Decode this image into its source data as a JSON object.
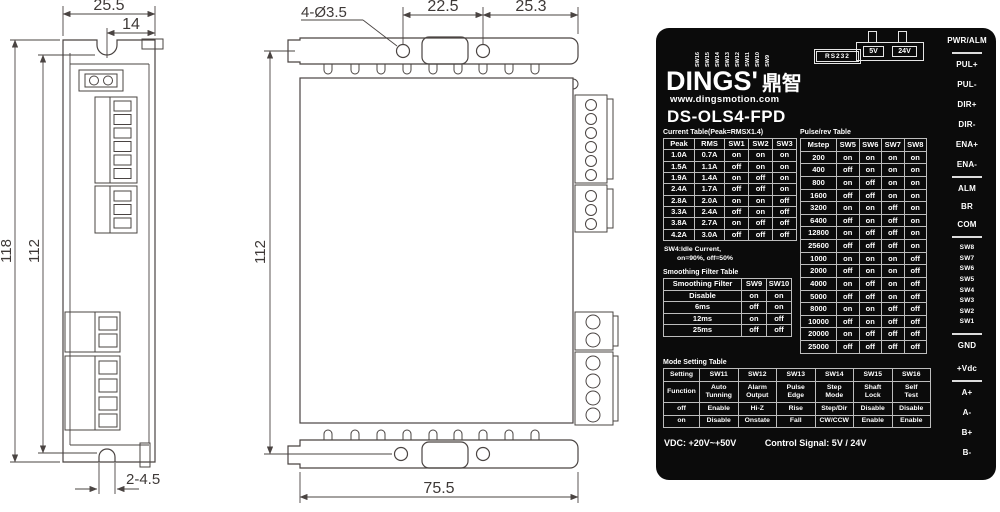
{
  "colors": {
    "panel_bg": "#0b0b0b",
    "panel_text": "#ffffff",
    "drawing_line": "#4a4442"
  },
  "front_view": {
    "dim_width": "25.5",
    "dim_notch": "14",
    "dim_height_outer": "118",
    "dim_height_inner": "112",
    "dim_slot": "2-4.5"
  },
  "side_view": {
    "dim_holes": "4-Ø3.5",
    "dim_hole_spacing": "22.5",
    "dim_edge_offset": "25.3",
    "dim_height": "112",
    "dim_width": "75.5"
  },
  "panel": {
    "brand": "DINGS'",
    "brand_cn": "鼎智",
    "website": "www.dingsmotion.com",
    "model": "DS-OLS4-FPD",
    "dip_labels": [
      "SW16",
      "SW15",
      "SW14",
      "SW13",
      "SW12",
      "SW11",
      "SW10",
      "SW9"
    ],
    "rs232_label": "RS232",
    "jumper_5v": "5V",
    "jumper_24v": "24V",
    "current_table": {
      "title": "Current Table(Peak=RMSX1.4)",
      "headers": [
        "Peak",
        "RMS",
        "SW1",
        "SW2",
        "SW3"
      ],
      "rows": [
        [
          "1.0A",
          "0.7A",
          "on",
          "on",
          "on"
        ],
        [
          "1.5A",
          "1.1A",
          "off",
          "on",
          "on"
        ],
        [
          "1.9A",
          "1.4A",
          "on",
          "off",
          "on"
        ],
        [
          "2.4A",
          "1.7A",
          "off",
          "off",
          "on"
        ],
        [
          "2.8A",
          "2.0A",
          "on",
          "on",
          "off"
        ],
        [
          "3.3A",
          "2.4A",
          "off",
          "on",
          "off"
        ],
        [
          "3.8A",
          "2.7A",
          "on",
          "off",
          "off"
        ],
        [
          "4.2A",
          "3.0A",
          "off",
          "off",
          "off"
        ]
      ]
    },
    "current_note_1": "SW4:Idle Current,",
    "current_note_2": "on=90%, off=50%",
    "pulse_table": {
      "title": "Pulse/rev Table",
      "headers": [
        "Mstep",
        "SW5",
        "SW6",
        "SW7",
        "SW8"
      ],
      "rows": [
        [
          "200",
          "on",
          "on",
          "on",
          "on"
        ],
        [
          "400",
          "off",
          "on",
          "on",
          "on"
        ],
        [
          "800",
          "on",
          "off",
          "on",
          "on"
        ],
        [
          "1600",
          "off",
          "off",
          "on",
          "on"
        ],
        [
          "3200",
          "on",
          "on",
          "off",
          "on"
        ],
        [
          "6400",
          "off",
          "on",
          "off",
          "on"
        ],
        [
          "12800",
          "on",
          "off",
          "off",
          "on"
        ],
        [
          "25600",
          "off",
          "off",
          "off",
          "on"
        ],
        [
          "1000",
          "on",
          "on",
          "on",
          "off"
        ],
        [
          "2000",
          "off",
          "on",
          "on",
          "off"
        ],
        [
          "4000",
          "on",
          "off",
          "on",
          "off"
        ],
        [
          "5000",
          "off",
          "off",
          "on",
          "off"
        ],
        [
          "8000",
          "on",
          "on",
          "off",
          "off"
        ],
        [
          "10000",
          "off",
          "on",
          "off",
          "off"
        ],
        [
          "20000",
          "on",
          "off",
          "off",
          "off"
        ],
        [
          "25000",
          "off",
          "off",
          "off",
          "off"
        ]
      ]
    },
    "smoothing_table": {
      "title": "Smoothing Filter Table",
      "headers": [
        "Smoothing Filter",
        "SW9",
        "SW10"
      ],
      "rows": [
        [
          "Disable",
          "on",
          "on"
        ],
        [
          "6ms",
          "off",
          "on"
        ],
        [
          "12ms",
          "on",
          "off"
        ],
        [
          "25ms",
          "off",
          "off"
        ]
      ]
    },
    "mode_table": {
      "title": "Mode Setting Table",
      "headers": [
        "Setting",
        "SW11",
        "SW12",
        "SW13",
        "SW14",
        "SW15",
        "SW16"
      ],
      "rows": [
        [
          "Function",
          "Auto\nTunning",
          "Alarm\nOutput",
          "Pulse\nEdge",
          "Step\nMode",
          "Shaft\nLock",
          "Self\nTest"
        ],
        [
          "off",
          "Enable",
          "Hi-Z",
          "Rise",
          "Step/Dir",
          "Disable",
          "Disable"
        ],
        [
          "on",
          "Disable",
          "Onstate",
          "Fall",
          "CW/CCW",
          "Enable",
          "Enable"
        ]
      ]
    },
    "footer_vdc": "VDC: +20V~+50V",
    "footer_signal": "Control Signal: 5V / 24V",
    "right_labels": {
      "group_power": [
        "PWR/ALM"
      ],
      "group_ctrl": [
        "PUL+",
        "PUL-",
        "DIR+",
        "DIR-",
        "ENA+",
        "ENA-"
      ],
      "group_status": [
        "ALM",
        "BR",
        "COM"
      ],
      "group_dip": [
        "SW8",
        "SW7",
        "SW6",
        "SW5",
        "SW4",
        "SW3",
        "SW2",
        "SW1"
      ],
      "group_supply": [
        "GND",
        "+Vdc"
      ],
      "group_motor": [
        "A+",
        "A-",
        "B+",
        "B-"
      ]
    }
  }
}
